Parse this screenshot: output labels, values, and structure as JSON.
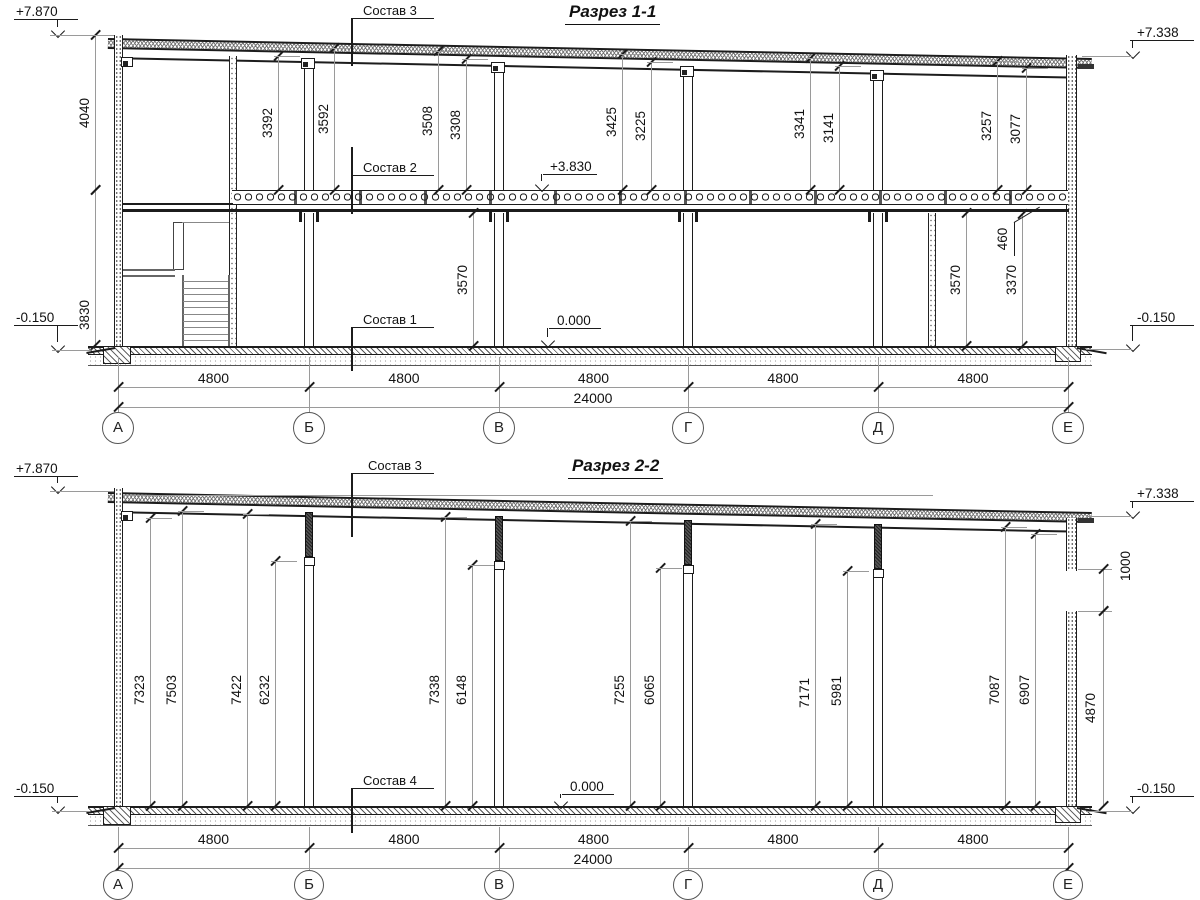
{
  "sheet": {
    "background": "#ffffff",
    "line_color": "#1c1c1c",
    "annotation_color": "#9a9a9a"
  },
  "axes": {
    "labels": [
      "А",
      "Б",
      "В",
      "Г",
      "Д",
      "Е"
    ],
    "x": [
      118,
      309,
      499,
      688,
      878,
      1068
    ],
    "bay_label": "4800",
    "total_label": "24000"
  },
  "sections": [
    {
      "title": "Разрез 1-1",
      "title_x": 565,
      "title_y": 2,
      "rows": {
        "dim1_y": 387,
        "dim2_y": 407,
        "bubble_y": 428,
        "bubble_r": 16,
        "ext_y1": 357,
        "ext_y2": 414
      },
      "elevations": [
        {
          "label": "+7.870",
          "tx": 16,
          "ty": 4,
          "sx": 14,
          "sw": 64,
          "sy": 19,
          "ax": 57,
          "tip": 34,
          "llx": 50,
          "llw": 64,
          "lly": 35
        },
        {
          "label": "+7.338",
          "tx": 1137,
          "ty": 25,
          "sx": 1130,
          "sw": 64,
          "sy": 40,
          "ax": 1132,
          "tip": 55,
          "llx": 1082,
          "llw": 50,
          "lly": 56
        },
        {
          "label": "-0.150",
          "tx": 16,
          "ty": 310,
          "sx": 14,
          "sw": 64,
          "sy": 325,
          "ax": 57,
          "tip": 349,
          "llx": 52,
          "llw": 38,
          "lly": 350
        },
        {
          "label": "-0.150",
          "tx": 1137,
          "ty": 310,
          "sx": 1130,
          "sw": 64,
          "sy": 325,
          "ax": 1132,
          "tip": 348,
          "llx": 1086,
          "llw": 46,
          "lly": 349
        },
        {
          "label": "+3.830",
          "tx": 550,
          "ty": 159,
          "sx": 543,
          "sw": 54,
          "sy": 174,
          "ax": 541,
          "tip": 188
        },
        {
          "label": "0.000",
          "tx": 557,
          "ty": 313,
          "sx": 549,
          "sw": 52,
          "sy": 328,
          "ax": 547,
          "tip": 344
        }
      ],
      "compositions": [
        {
          "label": "Состав 3",
          "tx": 363,
          "ty": 3,
          "ly": 18,
          "fy1": 18,
          "fy2": 66
        },
        {
          "label": "Состав 2",
          "tx": 363,
          "ty": 160,
          "ly": 175,
          "fy1": 147,
          "fy2": 214
        },
        {
          "label": "Состав 1",
          "tx": 363,
          "ty": 312,
          "ly": 327,
          "fy1": 327,
          "fy2": 371
        }
      ],
      "vdims": [
        {
          "v": "4040",
          "x": 95,
          "y1": 35,
          "y2": 190
        },
        {
          "v": "3830",
          "x": 95,
          "y1": 190,
          "y2": 345,
          "ly": 315
        },
        {
          "v": "3392",
          "x": 278,
          "y1": 56,
          "y2": 190,
          "ext": true
        },
        {
          "v": "3592",
          "x": 334,
          "y1": 48,
          "y2": 190,
          "ext": true
        },
        {
          "v": "3508",
          "x": 438,
          "y1": 51,
          "y2": 190,
          "ext": true
        },
        {
          "v": "3308",
          "x": 466,
          "y1": 59,
          "y2": 190,
          "ext": true
        },
        {
          "v": "3425",
          "x": 622,
          "y1": 54,
          "y2": 190,
          "ext": true
        },
        {
          "v": "3225",
          "x": 651,
          "y1": 62,
          "y2": 190,
          "ext": true
        },
        {
          "v": "3341",
          "x": 810,
          "y1": 58,
          "y2": 190,
          "ext": true
        },
        {
          "v": "3141",
          "x": 839,
          "y1": 66,
          "y2": 190,
          "ext": true
        },
        {
          "v": "3257",
          "x": 997,
          "y1": 61,
          "y2": 190,
          "ext": true
        },
        {
          "v": "3077",
          "x": 1026,
          "y1": 68,
          "y2": 190,
          "ext": true
        },
        {
          "v": "3570",
          "x": 473,
          "y1": 213,
          "y2": 346
        },
        {
          "v": "3570",
          "x": 966,
          "y1": 213,
          "y2": 346
        },
        {
          "v": "3370",
          "x": 1022,
          "y1": 214,
          "y2": 346
        }
      ],
      "leaders": [
        {
          "label": "460",
          "tx": 1003,
          "ty": 239,
          "ulx": 1014,
          "uly1": 222,
          "uly2": 256,
          "diag": {
            "x": 1014,
            "y": 206,
            "w": 30,
            "ang": -31
          }
        }
      ]
    },
    {
      "title": "Разрез 2-2",
      "title_x": 568,
      "title_y": 456,
      "rows": {
        "dim1_y": 848,
        "dim2_y": 868,
        "bubble_y": 885,
        "bubble_r": 15,
        "ext_y1": 827,
        "ext_y2": 872
      },
      "elevations": [
        {
          "label": "+7.870",
          "tx": 16,
          "ty": 461,
          "sx": 14,
          "sw": 64,
          "sy": 476,
          "ax": 57,
          "tip": 490,
          "llx": 50,
          "llw": 64,
          "lly": 491
        },
        {
          "label": "+7.338",
          "tx": 1137,
          "ty": 486,
          "sx": 1130,
          "sw": 64,
          "sy": 501,
          "ax": 1132,
          "tip": 515,
          "llx": 1086,
          "llw": 46,
          "lly": 516
        },
        {
          "label": "-0.150",
          "tx": 16,
          "ty": 781,
          "sx": 14,
          "sw": 64,
          "sy": 796,
          "ax": 57,
          "tip": 810,
          "llx": 52,
          "llw": 38,
          "lly": 811
        },
        {
          "label": "-0.150",
          "tx": 1137,
          "ty": 781,
          "sx": 1130,
          "sw": 64,
          "sy": 796,
          "ax": 1132,
          "tip": 810,
          "llx": 1086,
          "llw": 46,
          "lly": 811
        },
        {
          "label": "0.000",
          "tx": 570,
          "ty": 779,
          "sx": 562,
          "sw": 52,
          "sy": 794,
          "ax": 560,
          "tip": 805
        }
      ],
      "compositions": [
        {
          "label": "Состав 3",
          "tx": 368,
          "ty": 458,
          "ly": 473,
          "fy1": 473,
          "fy2": 537
        },
        {
          "label": "Состав 4",
          "tx": 363,
          "ty": 773,
          "ly": 788,
          "fy1": 788,
          "fy2": 833
        }
      ],
      "vdims": [
        {
          "v": "7323",
          "x": 150,
          "y1": 518,
          "y2": 806,
          "ly": 690,
          "ext": true
        },
        {
          "v": "7503",
          "x": 182,
          "y1": 511,
          "y2": 806,
          "ly": 690,
          "ext": true
        },
        {
          "v": "7422",
          "x": 247,
          "y1": 514,
          "y2": 806,
          "ly": 690,
          "ext": true
        },
        {
          "v": "6232",
          "x": 275,
          "y1": 561,
          "y2": 806,
          "ly": 690,
          "ext": true
        },
        {
          "v": "7338",
          "x": 445,
          "y1": 517,
          "y2": 806,
          "ly": 690,
          "ext": true
        },
        {
          "v": "6148",
          "x": 472,
          "y1": 565,
          "y2": 806,
          "ly": 690,
          "ext": true
        },
        {
          "v": "7255",
          "x": 630,
          "y1": 521,
          "y2": 806,
          "ly": 690,
          "ext": true
        },
        {
          "v": "6065",
          "x": 660,
          "y1": 568,
          "y2": 806,
          "ly": 690,
          "ext": true
        },
        {
          "v": "7171",
          "x": 815,
          "y1": 524,
          "y2": 806,
          "ly": 693,
          "ext": true
        },
        {
          "v": "5981",
          "x": 847,
          "y1": 571,
          "y2": 806,
          "ly": 691,
          "ext": true
        },
        {
          "v": "7087",
          "x": 1005,
          "y1": 527,
          "y2": 806,
          "ly": 690,
          "ext": true
        },
        {
          "v": "6907",
          "x": 1035,
          "y1": 534,
          "y2": 806,
          "ly": 690,
          "ext": true
        },
        {
          "v": "1000",
          "x": 1103,
          "y1": 569,
          "y2": 611,
          "lx": 1126,
          "ly": 566
        },
        {
          "v": "4870",
          "x": 1103,
          "y1": 611,
          "y2": 806,
          "lx": 1091,
          "ly": 708
        }
      ],
      "leaders": []
    }
  ]
}
